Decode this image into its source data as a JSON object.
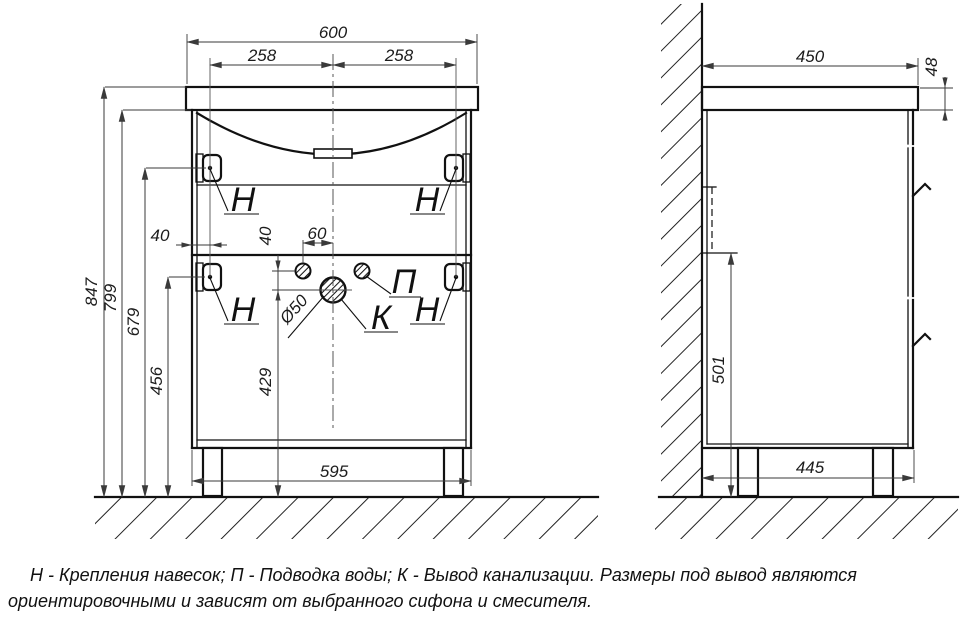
{
  "front_view": {
    "dims": {
      "top_width": "600",
      "bracket_left_offset": "258",
      "bracket_right_offset": "258",
      "total_height": "847",
      "body_height": "799",
      "upper_bracket_height": "679",
      "lower_bracket_height": "456",
      "outlet_height": "429",
      "bracket_side_offset": "40",
      "water_to_outlet": "40",
      "water_to_center": "60",
      "outlet_diameter": "Ø50",
      "bottom_width": "595"
    },
    "labels": {
      "bracket": "Н",
      "water_supply": "П",
      "sewage_outlet": "К"
    }
  },
  "side_view": {
    "dims": {
      "top_depth": "450",
      "top_thickness": "48",
      "back_cutout_height": "501",
      "bottom_depth": "445"
    }
  },
  "note": {
    "line1": "Н - Крепления навесок; П - Подводка воды; К - Вывод канализации. Размеры под вывод являются",
    "line2": "ориентировочными и зависят от выбранного сифона и смесителя."
  }
}
